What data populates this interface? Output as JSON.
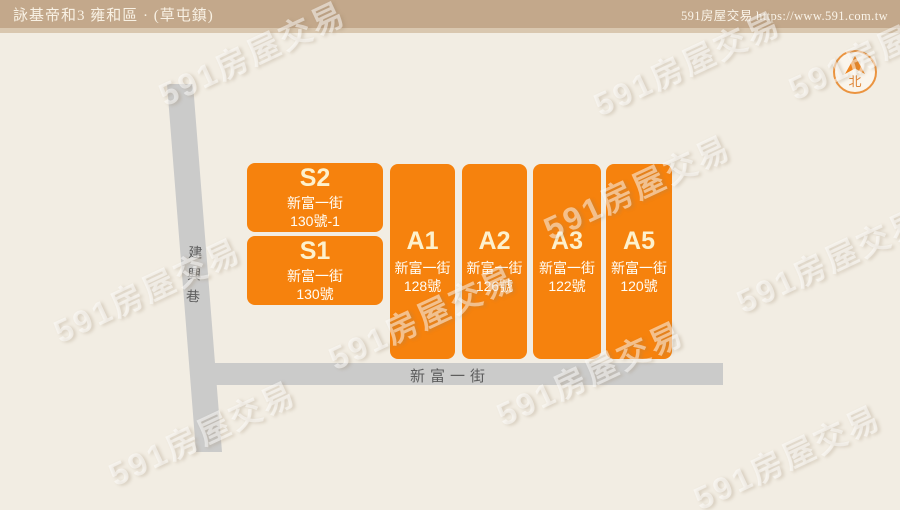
{
  "header": {
    "title": "詠基帝和3 雍和區 · (草屯鎮)",
    "brand": "591房屋交易",
    "url": "https://www.591.com.tw"
  },
  "compass": {
    "label": "北"
  },
  "roads": {
    "vertical": {
      "name": "建興巷"
    },
    "horizontal": {
      "name": "新富一街"
    }
  },
  "blocks": [
    {
      "id": "S2",
      "title": "S2",
      "address_street": "新富一街",
      "address_number": "130號-1"
    },
    {
      "id": "S1",
      "title": "S1",
      "address_street": "新富一街",
      "address_number": "130號"
    },
    {
      "id": "A1",
      "title": "A1",
      "address_street": "新富一街",
      "address_number": "128號"
    },
    {
      "id": "A2",
      "title": "A2",
      "address_street": "新富一街",
      "address_number": "126號"
    },
    {
      "id": "A3",
      "title": "A3",
      "address_street": "新富一街",
      "address_number": "122號"
    },
    {
      "id": "A5",
      "title": "A5",
      "address_street": "新富一街",
      "address_number": "120號"
    }
  ],
  "watermark": {
    "text": "591房屋交易"
  },
  "colors": {
    "header_bg": "#c3a88b",
    "background": "#f2ede3",
    "block_orange": "#f6820d",
    "road_gray": "#cbcbca",
    "compass_orange": "#eb9440",
    "road_text": "#5d5d5d"
  }
}
